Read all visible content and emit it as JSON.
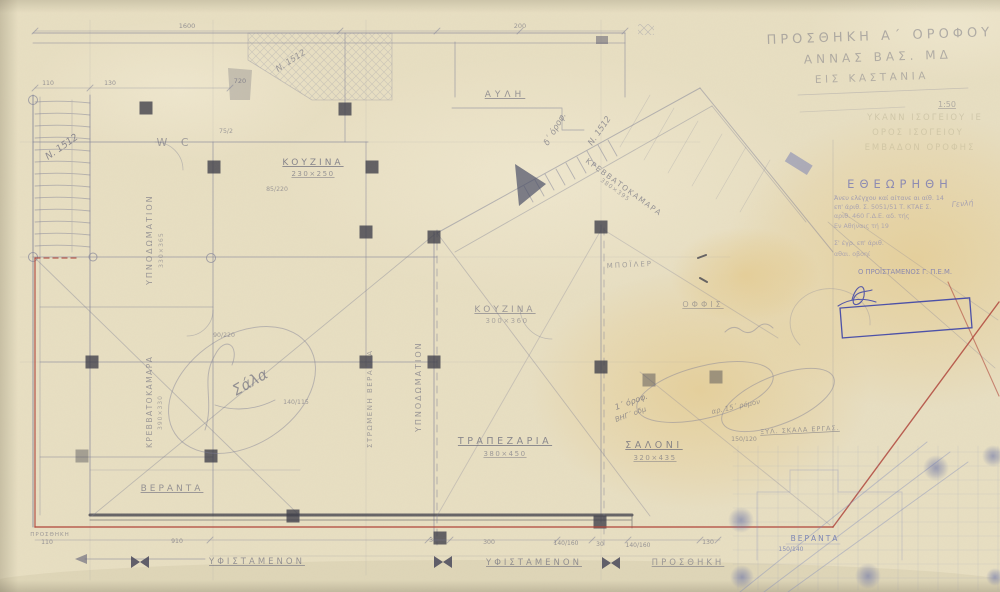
{
  "colors": {
    "paper": "#e8dfc2",
    "pencil_text": "#5d5e74",
    "pencil_line": "#7e7f97",
    "graphite_dark": "#45454f",
    "red_line": "#b0473c",
    "blue_ink": "#3a41a8",
    "blue_pencil": "#7d89bd",
    "stamp_ink": "#6b6fb5"
  },
  "title_block": {
    "line1": "ΠΡΟΣΘΗΚΗ Α΄ ΟΡΟΦΟΥ",
    "line2": "ΑΝΝΑΣ ΒΑΣ. ΜΔ",
    "line3": "ΕΙΣ ΚΑΣΤΑΝΙΑ",
    "scale": "1:50"
  },
  "ghost_text": {
    "line1": "ΥΚΑΝΝ ΙΣΟΓΕΙΟΥ ΙΕ",
    "line2": "ΟΡΟΣ ΙΣΟΓΕΙΟΥ",
    "line3": "ΕΜΒΑΔΟΝ ΟΡΟΦΗΣ"
  },
  "stamp": {
    "heading": "ΕΘΕΩΡΗΘΗ",
    "line1": "Άνευ ελέγχου καί αίτανε αι αίθ. 14",
    "line2": "επ' άριθ. Σ. 5051/51 Τ. ΚΤΑΕ Σ.",
    "line3": "αριθ. 460 Γ.Δ.Ε. αδ. τής",
    "line4": "Εν Αθήναις τή 19",
    "line5": "Σ' έγρ. επ' άριθ.",
    "line6": "αθαι. οβοηί",
    "signer": "Ο ΠΡΟΪΣΤΑΜΕΝΟΣ Γ. Π.Ε.Μ.",
    "handnote": "Γενλή"
  },
  "rooms": [
    {
      "name": "ΚΟΥΖΙΝΑ",
      "dims": "230×250"
    },
    {
      "name": "W C",
      "dims": ""
    },
    {
      "name": "ΑΥΛΗ",
      "dims": ""
    },
    {
      "name": "ΥΠΝΟΔΩΜΑΤΙΟΝ",
      "dims": "330×365"
    },
    {
      "name": "ΚΡΕΒΒΑΤΟΚΑΜΑΡΑ",
      "dims": "390×330"
    },
    {
      "name": "ΚΡΕΒΒΑΤΟΚΑΜΑΡΑ",
      "dims": "380×395"
    },
    {
      "name": "ΚΟΥΖΙΝΑ",
      "dims": "300×360"
    },
    {
      "name": "ΥΠΝΟΔΩΜΑΤΙΟΝ",
      "dims": ""
    },
    {
      "name": "ΣΤΡΩΜΕΝΗ ΒΕΡΑΝΔΑ",
      "dims": ""
    },
    {
      "name": "ΤΡΑΠΕΖΑΡΙΑ",
      "dims": "380×450"
    },
    {
      "name": "ΣΑΛΟΝΙ",
      "dims": "320×435"
    },
    {
      "name": "ΜΠΟΪΛΕΡ",
      "dims": ""
    },
    {
      "name": "ΟΦΦΙΣ",
      "dims": ""
    },
    {
      "name": "ΒΕΡΑΝΤΑ",
      "dims": ""
    },
    {
      "name": "ΞΥΛ. ΣΚΑΛΑ ΕΡΓΑΣ.",
      "dims": ""
    },
    {
      "name": "ΒΕΡΑΝΤΑ",
      "dims": "150/140"
    }
  ],
  "zones": {
    "existing1": "ΥΦΙΣΤΑΜΕΝΟΝ",
    "existing2": "ΥΦΙΣΤΑΜΕΝΟΝ",
    "addition": "ΠΡΟΣΘΗΚΗ",
    "addition_small": "ΠΡΟΣΘΗΚΗ"
  },
  "annotations": {
    "n1512a": "Ν. 1512",
    "n1512b": "Ν. 1512",
    "n1512c": "Ν. 1512",
    "d_orof": "δ΄ όροφ.",
    "sala": "Σάλα",
    "hand1": "1΄ όροφ.",
    "hand2": "ΒΗΓ΄ οδμ",
    "hand3": "αρ. 15΄ ρόμον"
  },
  "dimensions": {
    "top_len": "1600",
    "top_len2": "200",
    "d720": "720",
    "d110": "110",
    "d130": "130",
    "d75": "75/2",
    "d85": "85/220",
    "d90": "90/220",
    "d140115": "140/115",
    "d110b": "110",
    "d910": "910",
    "d30a": "30",
    "d300": "300",
    "d140160a": "140/160",
    "d30b": "30",
    "d140160b": "140/160",
    "d130b": "130",
    "d150120": "150/120"
  }
}
